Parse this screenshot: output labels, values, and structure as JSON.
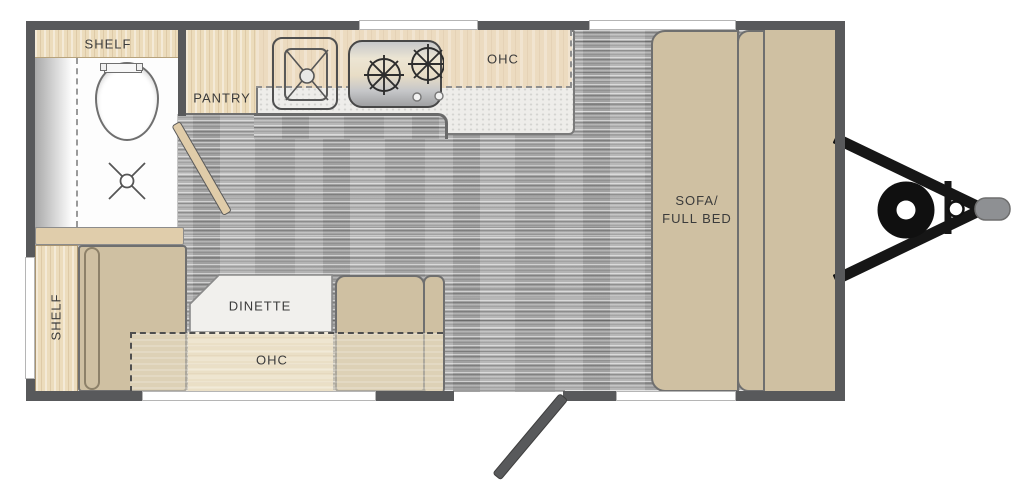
{
  "title": "Travel trailer floor plan",
  "labels": {
    "shelf_top": "SHELF",
    "pantry": "PANTRY",
    "ohc_kitchen": "OHC",
    "shelf_left": "SHELF",
    "dinette": "DINETTE",
    "ohc_dinette": "OHC",
    "sofa_line1": "SOFA/",
    "sofa_line2": "FULL BED"
  },
  "icons": [
    "toilet-icon",
    "shower-drain-icon",
    "shower-curtain-icon",
    "sink-icon",
    "stove-burner-icon",
    "door-swing-icon",
    "entry-door-icon",
    "hitch-a-frame-icon",
    "wheel-icon",
    "hitch-coupler-icon"
  ],
  "colors": {
    "wall": "#58595b",
    "furniture_tan": "#cfc0a2",
    "cabinet_light_wood": "#ecdcbc",
    "kitchen_ohc": "#ecdbc0",
    "counter": "#eeedea",
    "floor_gray": "#aeaeae",
    "hitch_black": "#161616",
    "coupler_gray": "#8e9093",
    "label_text": "#3b3b3b"
  }
}
